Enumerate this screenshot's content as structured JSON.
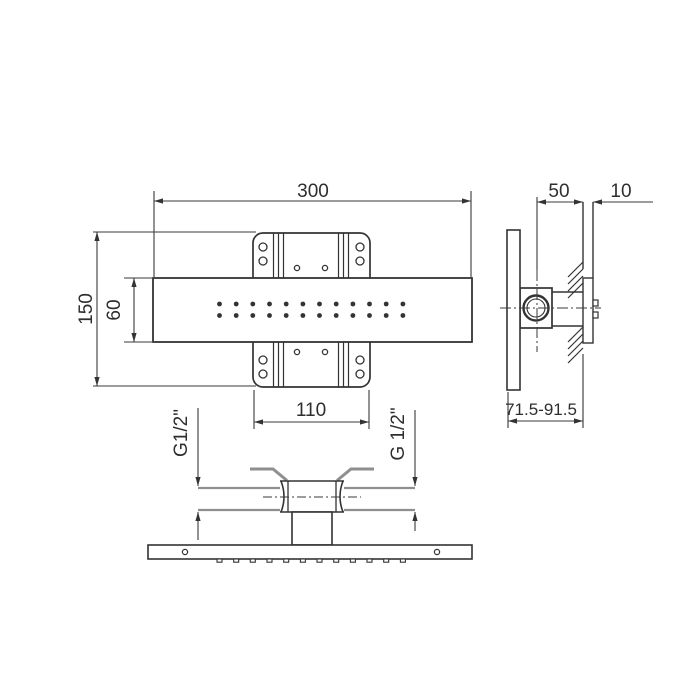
{
  "colors": {
    "line": "#333333",
    "thin_line": "#3a3a3a",
    "gray_line": "#8f8f8f",
    "text": "#2e2e2e",
    "background": "#ffffff"
  },
  "front_view": {
    "dim_width": "300",
    "dim_height": "150",
    "dim_bar_height": "60",
    "dim_bracket_width": "110",
    "nozzle_rows": 2,
    "nozzles_per_row": 12
  },
  "side_view": {
    "dim_center_offset": "50",
    "dim_wall_thickness": "10",
    "dim_depth_range": "71.5-91.5"
  },
  "bottom_view": {
    "thread_label_left": "G1/2\"",
    "thread_label_right": "G 1/2\"",
    "nozzle_outlets": 12
  }
}
